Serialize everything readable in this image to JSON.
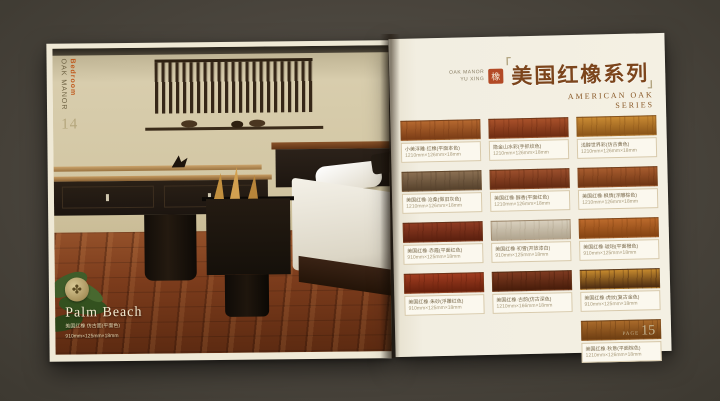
{
  "scene": {
    "background_color": "#4a453d"
  },
  "left_page": {
    "spine_label_primary": "Bedroom",
    "spine_label_secondary": "OAK MANOR",
    "page_number": "14",
    "brand": {
      "emblem_icon": "leaf-emblem",
      "name": "Palm Beach",
      "line1": "美国红橡 仿古面(平面色)",
      "line2": "910mm×125mm×18mm"
    }
  },
  "right_page": {
    "header": {
      "brand_small_line1": "OAK MANOR",
      "brand_small_line2": "YU XING",
      "seal_glyph": "橡",
      "title_cn": "美国红橡系列",
      "title_en_line1": "AMERICAN OAK",
      "title_en_line2": "SERIES",
      "accent_color": "#7c451c"
    },
    "samples": [
      {
        "name": "小美浮雕·红橡(平面本色)",
        "size": "1210mm×126mm×18mm",
        "base": "#b5682f",
        "streak": "#7a3c16"
      },
      {
        "name": "隐金山水彩(手抓纹色)",
        "size": "1210mm×126mm×18mm",
        "base": "#a9512a",
        "streak": "#6e2c12"
      },
      {
        "name": "浅醇世界彩(仿古黄色)",
        "size": "1210mm×126mm×18mm",
        "base": "#c98a33",
        "streak": "#8a5418"
      },
      {
        "name": "美国红橡·沧桑(做旧灰色)",
        "size": "1210mm×126mm×18mm",
        "base": "#8a6f52",
        "streak": "#55412c"
      },
      {
        "name": "美国红橡·醇香(平面红色)",
        "size": "1210mm×126mm×18mm",
        "base": "#9c4f2c",
        "streak": "#632a12"
      },
      {
        "name": "美国红橡·枫情(浮雕棕色)",
        "size": "1210mm×126mm×18mm",
        "base": "#a85c2e",
        "streak": "#6e3514"
      },
      {
        "name": "美国红橡·赤霞(平面红色)",
        "size": "910mm×125mm×18mm",
        "base": "#8e3b22",
        "streak": "#5a1f0e"
      },
      {
        "name": "美国红橡·初雪(开放漆白)",
        "size": "910mm×125mm×18mm",
        "base": "#d8cfbd",
        "streak": "#b0a48e"
      },
      {
        "name": "美国红橡·琥珀(平面橙色)",
        "size": "910mm×125mm×18mm",
        "base": "#bc6a2c",
        "streak": "#844312"
      },
      {
        "name": "美国红橡·朱砂(浮雕红色)",
        "size": "910mm×125mm×18mm",
        "base": "#a03c20",
        "streak": "#66200c"
      },
      {
        "name": "美国红橡·古韵(仿古深色)",
        "size": "1210mm×166mm×18mm",
        "base": "#7e3a20",
        "streak": "#471c0a"
      },
      {
        "name": "美国红橡·虎纹(复古金色)",
        "size": "910mm×125mm×18mm",
        "base": "#c68a2e",
        "streak": "#4a2a10"
      },
      {
        "name": "美国红橡·秋意(平面棕色)",
        "size": "1210mm×126mm×18mm",
        "base": "#a96a2a",
        "streak": "#6e3e12"
      }
    ],
    "page_label": "PAGE",
    "page_number": "15"
  }
}
